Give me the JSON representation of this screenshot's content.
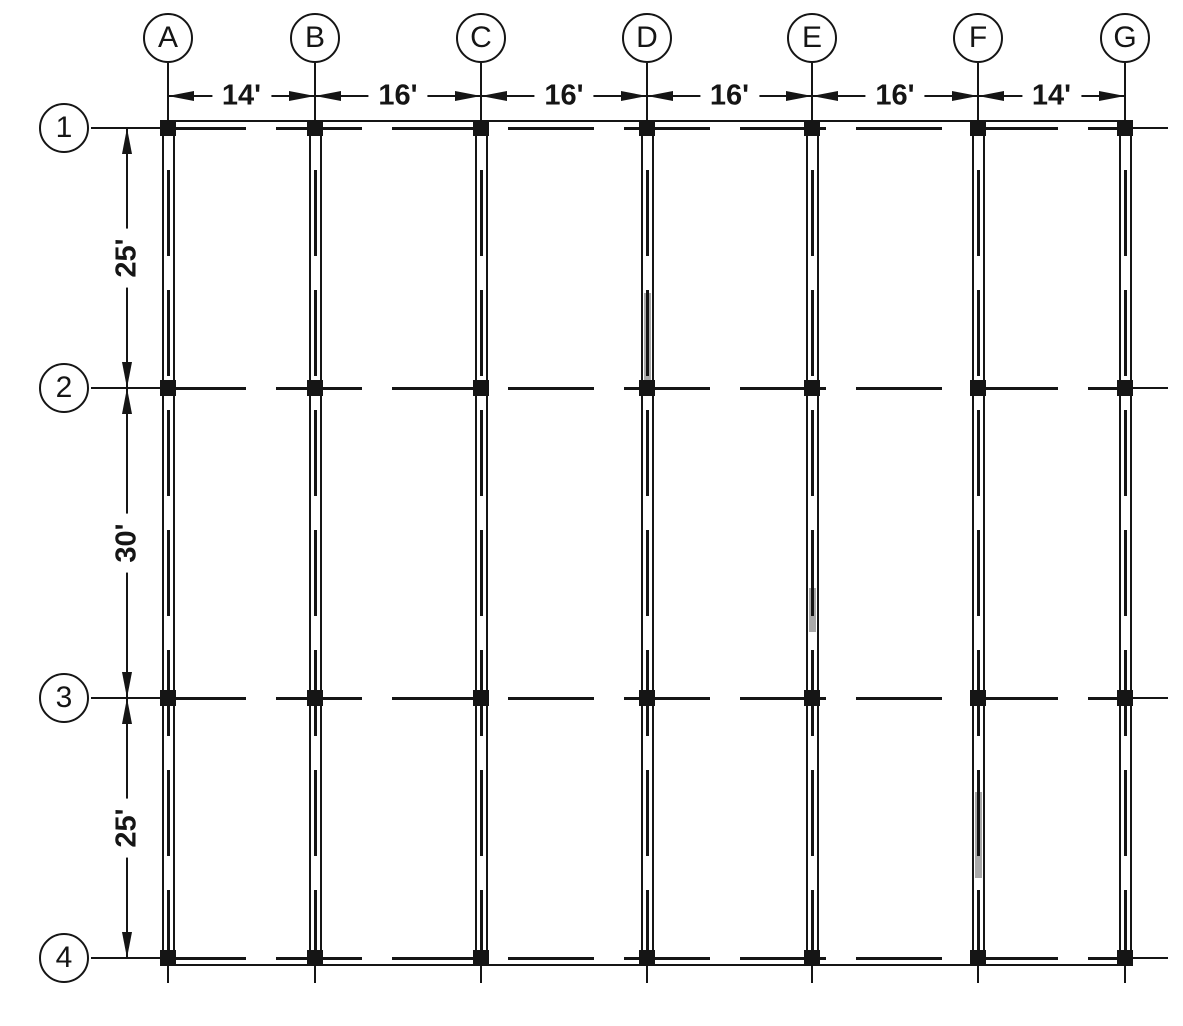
{
  "meta": {
    "background": "#ffffff",
    "ink": "#151515",
    "highlight": "#a9a9a9"
  },
  "grid": {
    "columns": [
      {
        "label": "A",
        "x": 168
      },
      {
        "label": "B",
        "x": 315
      },
      {
        "label": "C",
        "x": 481
      },
      {
        "label": "D",
        "x": 647
      },
      {
        "label": "E",
        "x": 812
      },
      {
        "label": "F",
        "x": 978
      },
      {
        "label": "G",
        "x": 1125
      }
    ],
    "rows": [
      {
        "label": "1",
        "y": 128
      },
      {
        "label": "2",
        "y": 388
      },
      {
        "label": "3",
        "y": 698
      },
      {
        "label": "4",
        "y": 958
      }
    ]
  },
  "dimensions": {
    "top": {
      "labels": [
        "14'",
        "16'",
        "16'",
        "16'",
        "16'",
        "14'"
      ]
    },
    "left": {
      "labels": [
        "25'",
        "30'",
        "25'"
      ]
    }
  },
  "highlights": [
    {
      "column": "D",
      "from_y": 293,
      "to_y": 380
    },
    {
      "column": "E",
      "from_y": 588,
      "to_y": 632
    },
    {
      "column": "F",
      "from_y": 792,
      "to_y": 878
    }
  ]
}
